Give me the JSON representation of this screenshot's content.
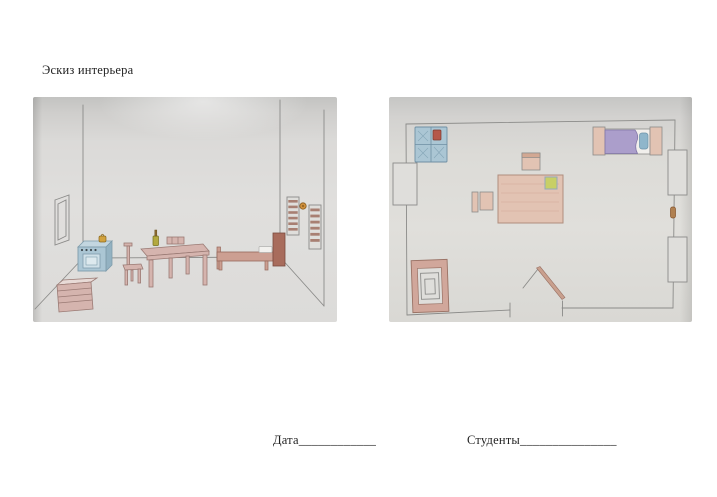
{
  "page": {
    "title": "Эскиз интерьера",
    "date_label": "Дата____________",
    "students_label": "Студенты_______________"
  },
  "sketches": {
    "perspective": {
      "label": "hand-drawn perspective sketch of a room interior",
      "objects": [
        "window-left-wall",
        "stove",
        "kettle",
        "shelf-stack",
        "chair",
        "table",
        "bottle",
        "chair-behind-table",
        "bed",
        "pillow",
        "headboard",
        "louver-window-upper",
        "louver-window-lower",
        "wall-clock"
      ]
    },
    "floor_plan": {
      "label": "hand-drawn floor plan of the same room",
      "objects": [
        "stove-top",
        "kettle-red",
        "bed-top",
        "pillow",
        "blanket",
        "window-left",
        "window-right-upper",
        "window-right-lower",
        "wall-vent",
        "table-top",
        "napkin",
        "chair-top",
        "chair-left",
        "cabinet-top",
        "door-open"
      ]
    }
  },
  "colors": {
    "ink": "#1f1f1f",
    "pencil": "#8b8b89",
    "paper_light": "#dfdedb",
    "stove_blue": "#abc6d4",
    "stove_blue_dark": "#7f9cab",
    "kettle_yellow": "#d2a23e",
    "kettle_red": "#b5574a",
    "wood_pink": "#d5b4ae",
    "wood_outline": "#9a7a74",
    "headboard": "#a86c5c",
    "slat_brown": "#a87f72",
    "clock_orange": "#cf8f3b",
    "blanket_purple": "#ab9ecb",
    "pillow_blue": "#8fb6cb",
    "napkin_green": "#c8cf66",
    "table_tan": "#e2c3b3",
    "door_tan": "#c9a08e"
  }
}
